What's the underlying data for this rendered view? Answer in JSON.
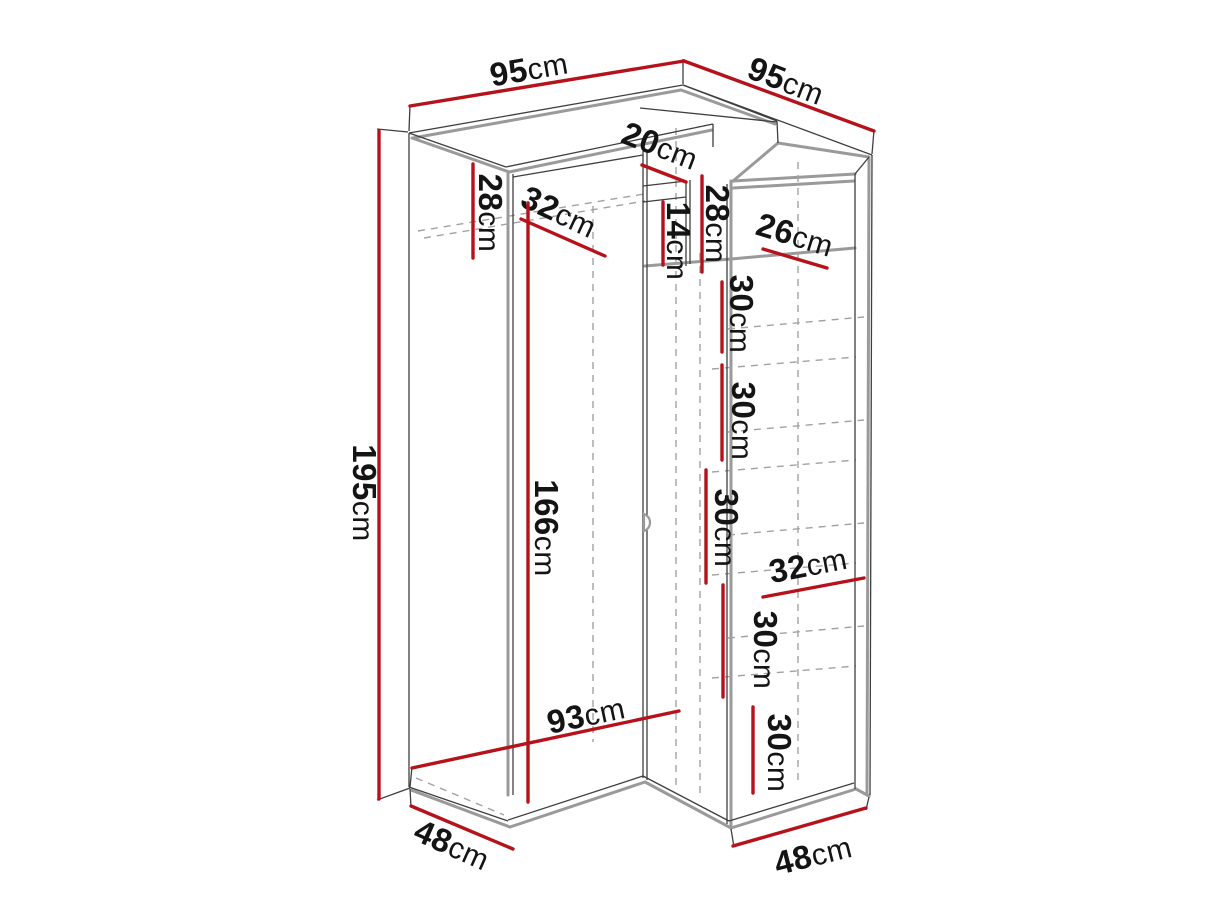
{
  "diagram": {
    "title": "corner wardrobe dimension drawing",
    "type": "furniture-technical-diagram",
    "background": "#ffffff",
    "line_colors": {
      "outline": "#3f3f3f",
      "panel": "#9a9a9a",
      "hidden": "#a2a2a2",
      "dimension": "#b5121b",
      "label": "#141414"
    },
    "dimensions": [
      {
        "id": "top-width-left",
        "value": "95",
        "unit": "cm"
      },
      {
        "id": "top-width-right",
        "value": "95",
        "unit": "cm"
      },
      {
        "id": "total-height",
        "value": "195",
        "unit": "cm"
      },
      {
        "id": "left-top-compartment-height",
        "value": "28",
        "unit": "cm"
      },
      {
        "id": "left-top-shelf-width",
        "value": "32",
        "unit": "cm"
      },
      {
        "id": "corner-front-width",
        "value": "20",
        "unit": "cm"
      },
      {
        "id": "corner-niche-height",
        "value": "14",
        "unit": "cm"
      },
      {
        "id": "right-top-compartment-height",
        "value": "28",
        "unit": "cm"
      },
      {
        "id": "right-top-shelf-width",
        "value": "26",
        "unit": "cm"
      },
      {
        "id": "shelf-spacing-1",
        "value": "30",
        "unit": "cm"
      },
      {
        "id": "shelf-spacing-2",
        "value": "30",
        "unit": "cm"
      },
      {
        "id": "shelf-spacing-3",
        "value": "30",
        "unit": "cm"
      },
      {
        "id": "shelf-spacing-4",
        "value": "30",
        "unit": "cm"
      },
      {
        "id": "shelf-spacing-5",
        "value": "30",
        "unit": "cm"
      },
      {
        "id": "door-height",
        "value": "166",
        "unit": "cm"
      },
      {
        "id": "right-shelf-width",
        "value": "32",
        "unit": "cm"
      },
      {
        "id": "front-bottom-width",
        "value": "93",
        "unit": "cm"
      },
      {
        "id": "left-depth",
        "value": "48",
        "unit": "cm"
      },
      {
        "id": "right-depth",
        "value": "48",
        "unit": "cm"
      }
    ]
  }
}
